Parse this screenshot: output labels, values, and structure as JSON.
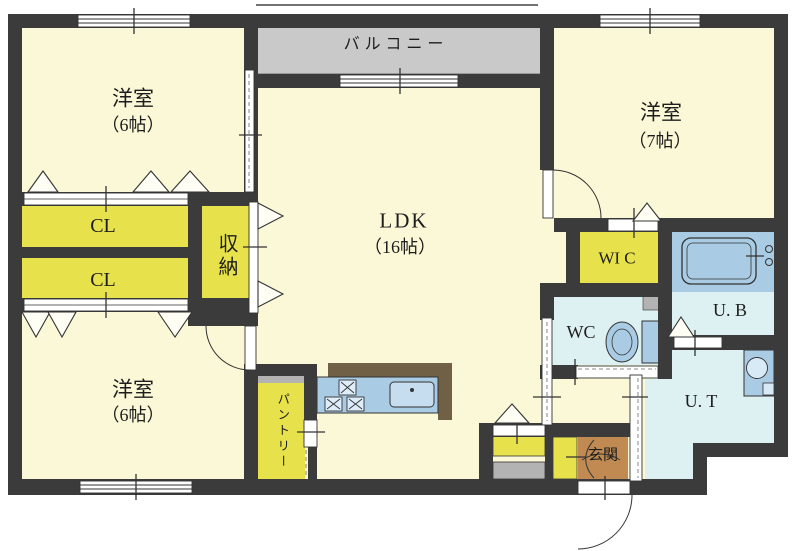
{
  "page": {
    "type": "apartment-floor-plan",
    "background": "#ffffff"
  },
  "labels": {
    "balcony": "バルコニー",
    "bedroom_top_left": "洋室",
    "bedroom_top_left_size": "（6帖）",
    "bedroom_top_right": "洋室",
    "bedroom_top_right_size": "（7帖）",
    "bedroom_bottom_left": "洋室",
    "bedroom_bottom_left_size": "（6帖）",
    "ldk": "LDK",
    "ldk_size": "（16帖）",
    "closet_upper": "CL",
    "closet_lower": "CL",
    "storage": "収納",
    "walk_in_closet": "WI C",
    "toilet_room": "WC",
    "unit_bath": "U. B",
    "utility": "U. T",
    "pantry": "パントリー",
    "entrance": "玄関"
  },
  "colors": {
    "wall": "#3b3b3b",
    "room_floor": "#fbf8d7",
    "closet_yellow": "#e7e24c",
    "balcony_gray": "#c9c9c9",
    "balcony_edge_brown": "#6f6046",
    "wet_area_cyan": "#ddf0f2",
    "fixture_blue": "#a9cbe3",
    "entrance_brown": "#c08a52",
    "counter_brown": "#6f6046",
    "step_gray": "#b3b3b3"
  }
}
